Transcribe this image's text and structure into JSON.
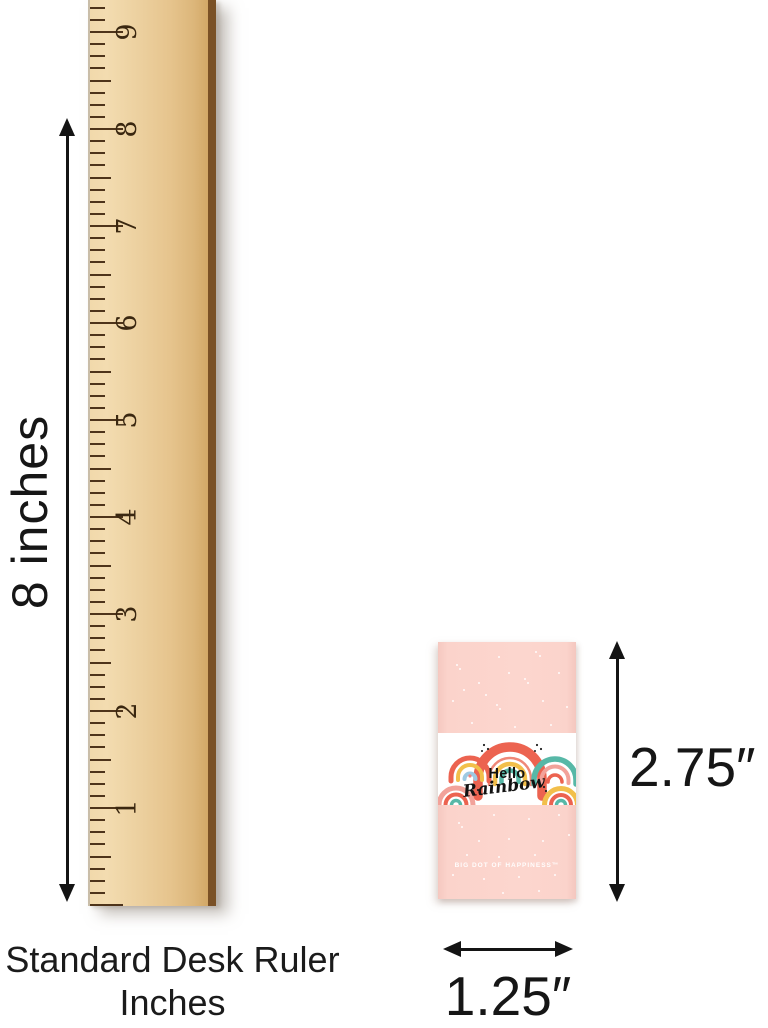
{
  "ruler": {
    "height_label": "8 inches",
    "caption_line1": "Standard Desk Ruler",
    "caption_line2": "Inches",
    "numbers": [
      "9",
      "8",
      "7",
      "6",
      "5",
      "4",
      "3",
      "2",
      "1"
    ],
    "colors": {
      "wood": "#ecd09f",
      "edge": "#7a5126",
      "tick": "#4e341a",
      "numeral": "#3a2710"
    }
  },
  "product": {
    "band": {
      "title_line1": "Hello",
      "title_line2": "Rainbow"
    },
    "brand_text": "BIG DOT OF HAPPINESS™",
    "height_label": "2.75″",
    "width_label": "1.25″",
    "colors": {
      "wrapper_pink": "#fbd3cb",
      "coral": "#ec6350",
      "coral_light": "#ef8878",
      "yellow": "#f2bf4b",
      "teal": "#57b8a7",
      "pink": "#f2a29a",
      "blue": "#9ec9e2",
      "heart": "#f2837c"
    }
  },
  "annotation_color": "#141414"
}
